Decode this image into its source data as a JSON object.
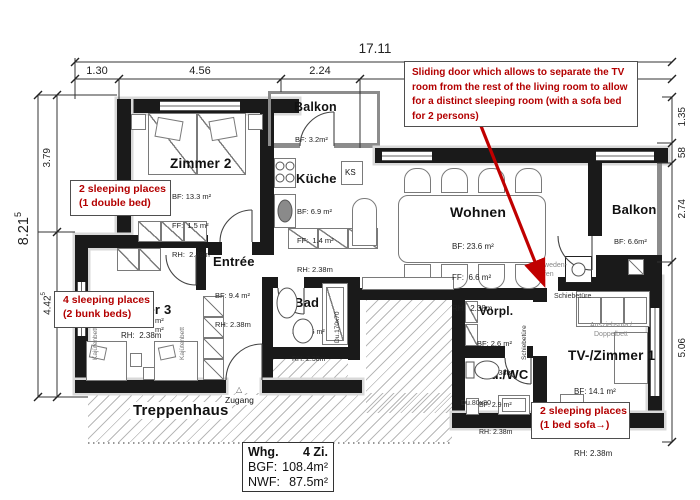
{
  "dimensions": {
    "top_total": "17.11",
    "top_segments": [
      "1.30",
      "4.56",
      "2.24"
    ],
    "left_total": "8.21",
    "left_total_sup": "5",
    "left_seg1": "3.79",
    "left_seg2": "4.42",
    "left_seg2_sup": "5",
    "right_segments": [
      "1.35",
      "58",
      "2.74",
      "5.06"
    ]
  },
  "notes": {
    "sliding_door": "Sliding door which allows to separate the TV room from the rest of the living room to allow for a distinct sleeping room (with a sofa bed for 2 persons)",
    "zimmer2_l1": "2 sleeping places",
    "zimmer2_l2": "(1 double bed)",
    "zimmer3_l1": "4 sleeping places",
    "zimmer3_l2": "(2 bunk beds)",
    "tv_l1": "2 sleeping places",
    "tv_l2": "(1 bed sofa→)"
  },
  "rooms": {
    "zimmer2": {
      "name": "Zimmer 2",
      "l1": "BF: 13.3 m²",
      "l2": "FF:  1.5 m²",
      "l3": "RH:  2.38m"
    },
    "balkon_top": {
      "name": "Balkon",
      "l1": "BF: 3.2m²"
    },
    "kueche": {
      "name": "Küche",
      "l1": "BF: 6.9 m²",
      "l2": "FF:  1.4 m²",
      "l3": "RH: 2.38m"
    },
    "wohnen": {
      "name": "Wohnen",
      "l1": "BF: 23.6 m²",
      "l2": "FF:  6.6 m²",
      "l3": "RH:  2.38m"
    },
    "balkon_right": {
      "name": "Balkon",
      "l1": "BF: 6.6m²"
    },
    "entree": {
      "name": "Entrée",
      "l1": "BF: 9.4 m²",
      "l2": "RH: 2.38m"
    },
    "zimmer3": {
      "name": "Zimmer 3",
      "frag1": "m²",
      "frag2": "m²",
      "l3": "RH:  2.38m"
    },
    "bad": {
      "name": "Bad",
      "l1": "BF: 3.6 m²",
      "l2": "RH: 2.38m"
    },
    "vorpl": {
      "name": "Vorpl.",
      "l1": "BF: 2.6 m²",
      "l2": "RH: 2.38m"
    },
    "duwc": {
      "name": "Du./WC",
      "l1": "BF: 2.9 m²",
      "l2": "RH: 2.38m"
    },
    "tv": {
      "name": "TV-/Zimmer 1",
      "l1": "BF: 14.1 m²",
      "l2": "FF:  2.6 m²",
      "l3": "RH: 2.38m"
    }
  },
  "labels": {
    "ks": "KS",
    "zugang": "Zugang",
    "zugang_marker": "△",
    "treppenhaus": "Treppenhaus",
    "kajuetenbett": "Kajütenbett",
    "schiebetuere": "Schiebetüre",
    "schweden1": "Schweden-",
    "schweden2": "ofen",
    "ausziehsofa": "Ausziehsofa /",
    "doppelbett": "Doppelbett",
    "du_bad": "Du.170x70",
    "du_wc": "Du.80x80"
  },
  "title_block": {
    "r1l": "Whg.",
    "r1v": "4 Zi.",
    "r2l": "BGF:",
    "r2v": "108.4m²",
    "r3l": "NWF:",
    "r3v": "87.5m²"
  }
}
